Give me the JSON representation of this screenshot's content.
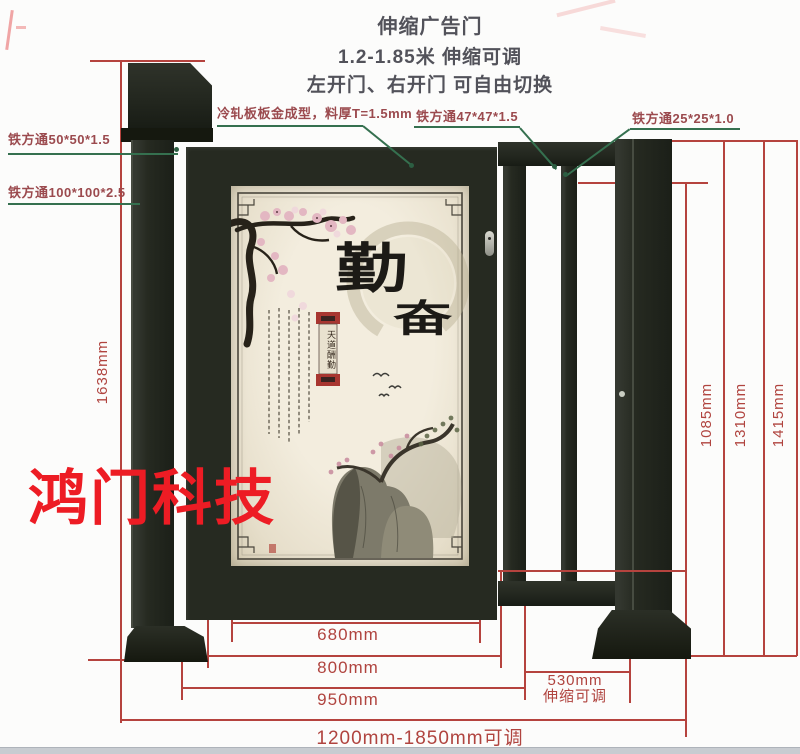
{
  "header": {
    "line1": "伸缩广告门",
    "line2": "1.2-1.85米 伸缩可调",
    "line3": "左开门、右开门 可自由切换"
  },
  "part_labels": {
    "tube50": "铁方通50*50*1.5",
    "tube100": "铁方通100*100*2.5",
    "panel": "冷轧板板金成型，料厚T=1.5mm",
    "tube47": "铁方通47*47*1.5",
    "tube25": "铁方通25*25*1.0"
  },
  "dimensions": {
    "left_height": "1638mm",
    "inner_height": "1085mm",
    "frame_height": "1310mm",
    "total_height": "1415mm",
    "poster_width": "680mm",
    "door_width": "800mm",
    "leaf_width": "950mm",
    "telescopic_width": "530mm",
    "telescopic_note": "伸缩可调",
    "total_range": "1200mm-1850mm可调"
  },
  "watermark": "鸿门科技",
  "poster": {
    "char_main": "勤",
    "char_sub": "奋",
    "ribbon_text": "天道酬勤"
  },
  "colors": {
    "dimension_red": "#b0443f",
    "leader_green": "#35704f",
    "label_maroon": "#9b4a4e",
    "watermark_red": "#ed1c24",
    "metal_dark": "#23271f"
  }
}
